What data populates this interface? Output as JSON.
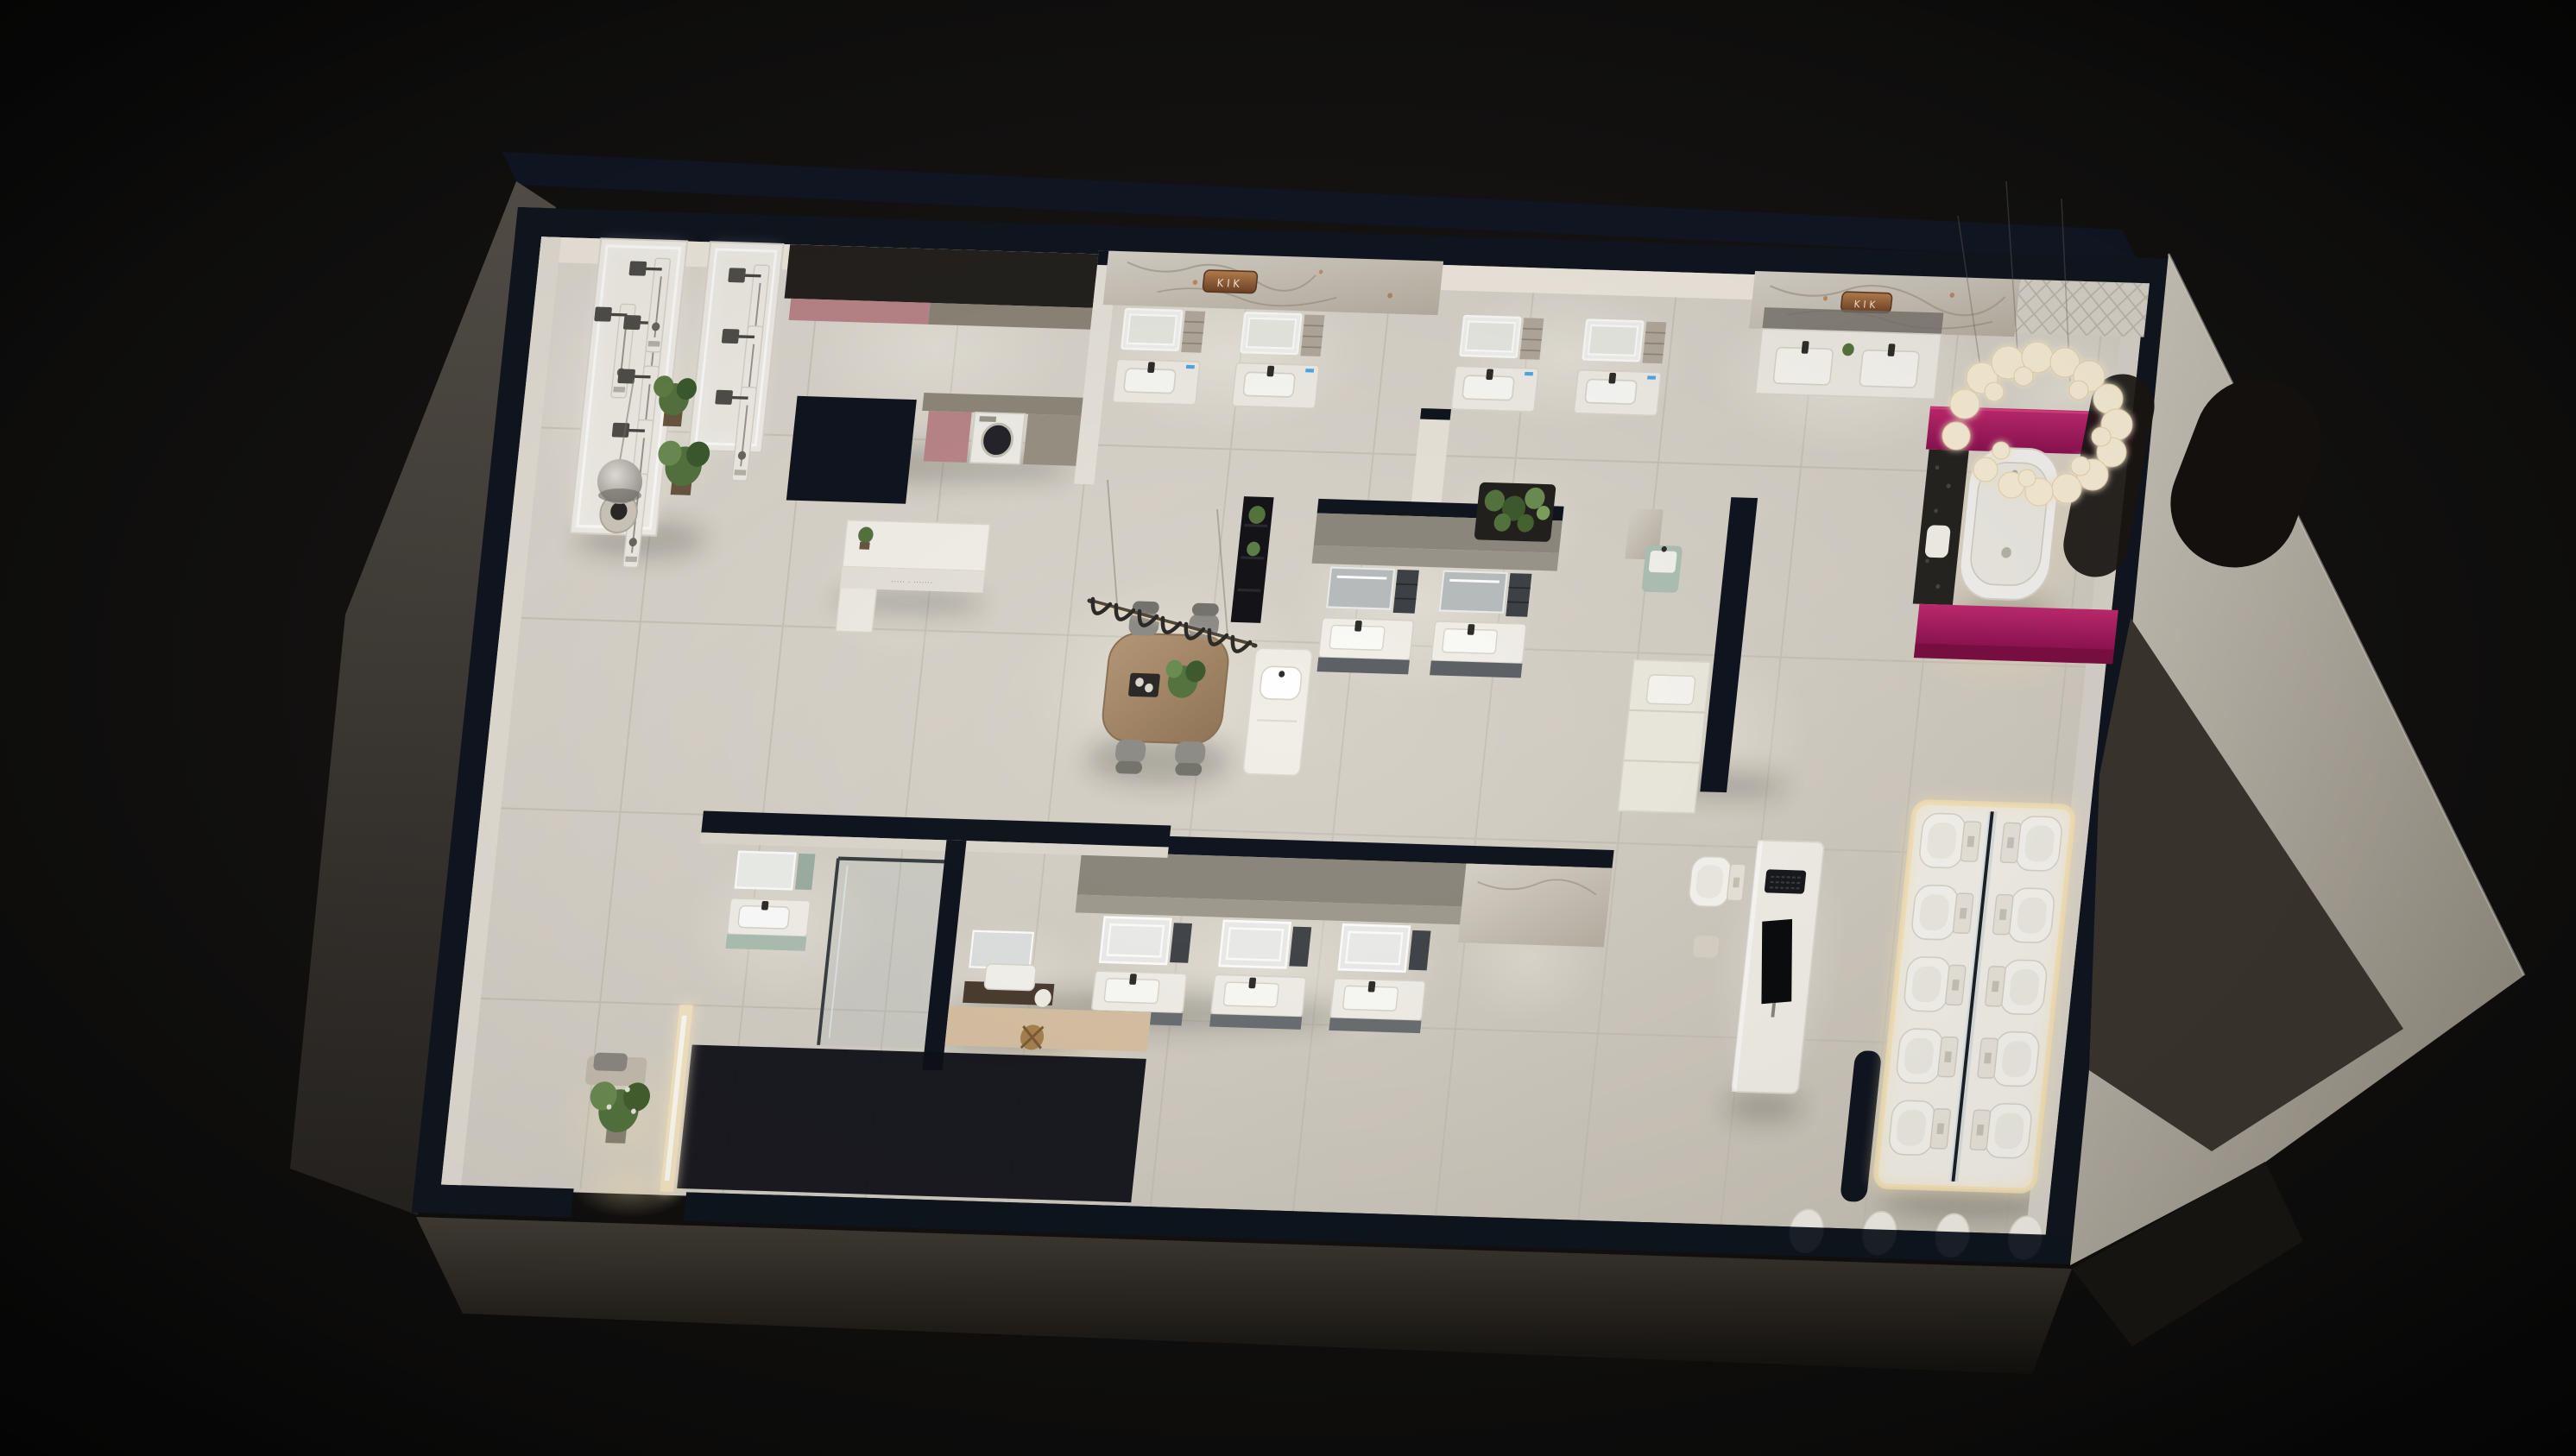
{
  "scene": {
    "title": "Bathroom showroom — 3D dollhouse floor plan render (night)",
    "view": "isometric cutaway from above",
    "brand": "KIK"
  },
  "signs": {
    "brand_wall_center": "KIK",
    "brand_wall_right": "KIK",
    "reception_slogan": "····· · ·······"
  },
  "palette": {
    "bg": "#0b0a09",
    "wallTop": "#10151f",
    "floor": "#d6d1c7",
    "wallFace": "#efe9df",
    "marble": "#d8d2c8",
    "magenta": "#a8195d",
    "magentaDark": "#7c0f42",
    "copper": "#8f5c33",
    "dustyPink": "#bb868a",
    "sage": "#afc0b4",
    "wood": "#ab8e6d",
    "graphite": "#24211d",
    "fixtureWhite": "#f4f1ea",
    "ledWarm": "#f6e7c4",
    "plantGreen": "#55743f",
    "glass": "#9fb6bc",
    "terrace": "#3a352e",
    "shell": "#4a453e"
  },
  "rooms": [
    "shower fixture gallery",
    "laundry display",
    "reception counter",
    "stone-wall vanity bay",
    "central lounge with dining table",
    "vanity studios",
    "magenta bathtub suite",
    "toilet display gallery",
    "shower rooms",
    "entrance nook"
  ],
  "fixtures": {
    "shower_columns": 8,
    "vanity_units": 14,
    "toilets_on_platform": 10,
    "smart_toilet": 1,
    "freestanding_bathtub": 1,
    "washing_machine": 1,
    "dining_chairs": 4,
    "pendant_hooks": 7,
    "chandelier_bulbs": 22,
    "edge_basins": 4,
    "plants": 9
  }
}
